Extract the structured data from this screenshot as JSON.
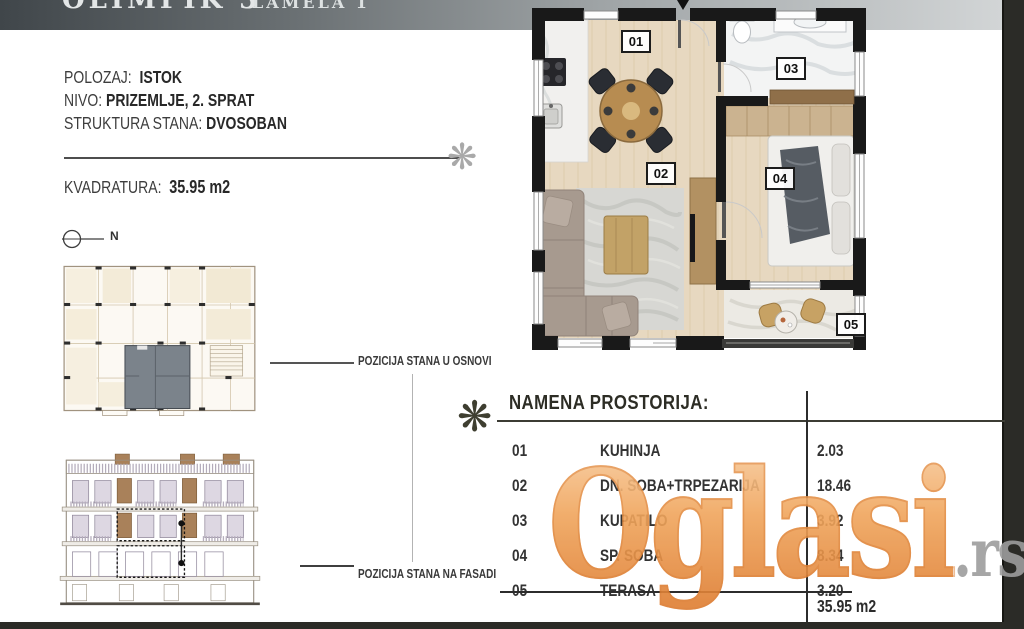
{
  "header": {
    "title": "OLIMPIK 3",
    "subtitle": "LAMELA 1"
  },
  "details": {
    "polozaj_label": "POLOZAJ:",
    "polozaj_value": "ISTOK",
    "nivo_label": "NIVO:",
    "nivo_value": "PRIZEMLJE, 2. SPRAT",
    "struktura_label": "STRUKTURA STANA:",
    "struktura_value": "DVOSOBAN",
    "kvadratura_label": "KVADRATURA:",
    "kvadratura_value": "35.95 m2"
  },
  "compass": {
    "label": "N"
  },
  "captions": {
    "plan": "POZICIJA STANA U OSNOVI",
    "facade": "POZICIJA STANA NA FASADI"
  },
  "floorplan": {
    "room_labels": [
      "01",
      "02",
      "03",
      "04",
      "05"
    ]
  },
  "table": {
    "title": "NAMENA PROSTORIJA:",
    "rows": [
      {
        "num": "01",
        "name": "KUHINJA",
        "area": "2.03"
      },
      {
        "num": "02",
        "name": "DN. SOBA+TRPEZARIJA",
        "area": "18.46"
      },
      {
        "num": "03",
        "name": "KUPATILO",
        "area": "3.92"
      },
      {
        "num": "04",
        "name": "SP. SOBA",
        "area": "8.34"
      },
      {
        "num": "05",
        "name": "TERASA",
        "area": "3.20"
      }
    ],
    "total": "35.95 m2"
  },
  "watermark": {
    "main": "Oglasi",
    "suffix": ".rs",
    "colors": {
      "orange": "#ED9B52",
      "gray": "#9D9D9D"
    }
  },
  "colors": {
    "page_border": "#2b2b27",
    "header_dark": "#40464a",
    "header_light": "#d2d5d6"
  }
}
